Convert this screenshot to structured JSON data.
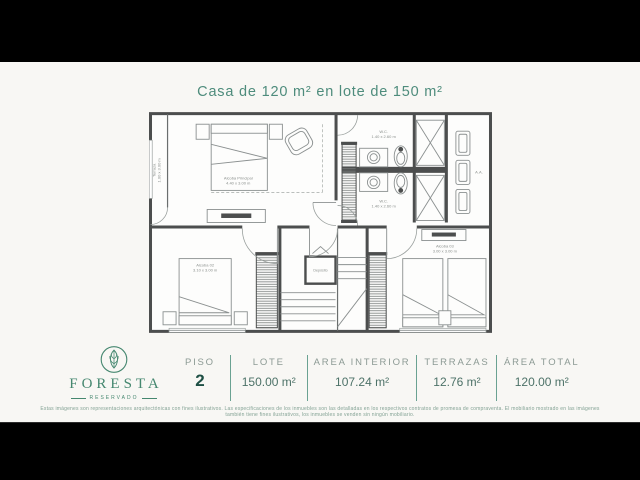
{
  "title": "Casa de 120 m² en lote de 150 m²",
  "plan": {
    "terraza": {
      "label": "Terraza",
      "dims": "1.00 x 3.00 m"
    },
    "alcoba_principal": {
      "label": "Alcoba Principal",
      "dims": "4.40 x 3.00 m"
    },
    "wc_top": {
      "label": "W.C.",
      "dims": "1.40 x 2.60 m"
    },
    "wc_bottom": {
      "label": "W.C.",
      "dims": "1.40 x 2.60 m"
    },
    "aa": {
      "label": "A.A."
    },
    "alcoba_02": {
      "label": "Alcoba 02",
      "dims": "3.10 x 3.00 m"
    },
    "deposito": {
      "label": "Depósito"
    },
    "alcoba_03": {
      "label": "Alcoba 03",
      "dims": "3.00 x 3.00 m"
    }
  },
  "logo": {
    "name": "FORESTA",
    "subtitle": "RESERVADO"
  },
  "stats": [
    {
      "label": "PISO",
      "value": "2"
    },
    {
      "label": "LOTE",
      "value": "150.00 m²"
    },
    {
      "label": "AREA INTERIOR",
      "value": "107.24 m²"
    },
    {
      "label": "TERRAZAS",
      "value": "12.76 m²"
    },
    {
      "label": "ÁREA TOTAL",
      "value": "120.00 m²"
    }
  ],
  "disclaimer": "Estas imágenes son representaciones arquitectónicas con fines ilustrativos. Las especificaciones de los inmuebles son las detalladas en los respectivos contratos de promesa de compraventa. El mobiliario mostrado en las imágenes también tiene fines ilustrativos, los inmuebles se venden sin ningún mobiliario.",
  "colors": {
    "accent": "#4e8c7c",
    "label_text": "#8c9a94",
    "value_text": "#4d7268",
    "piso_value": "#1e4f44",
    "wall": "#4c4e4e"
  }
}
